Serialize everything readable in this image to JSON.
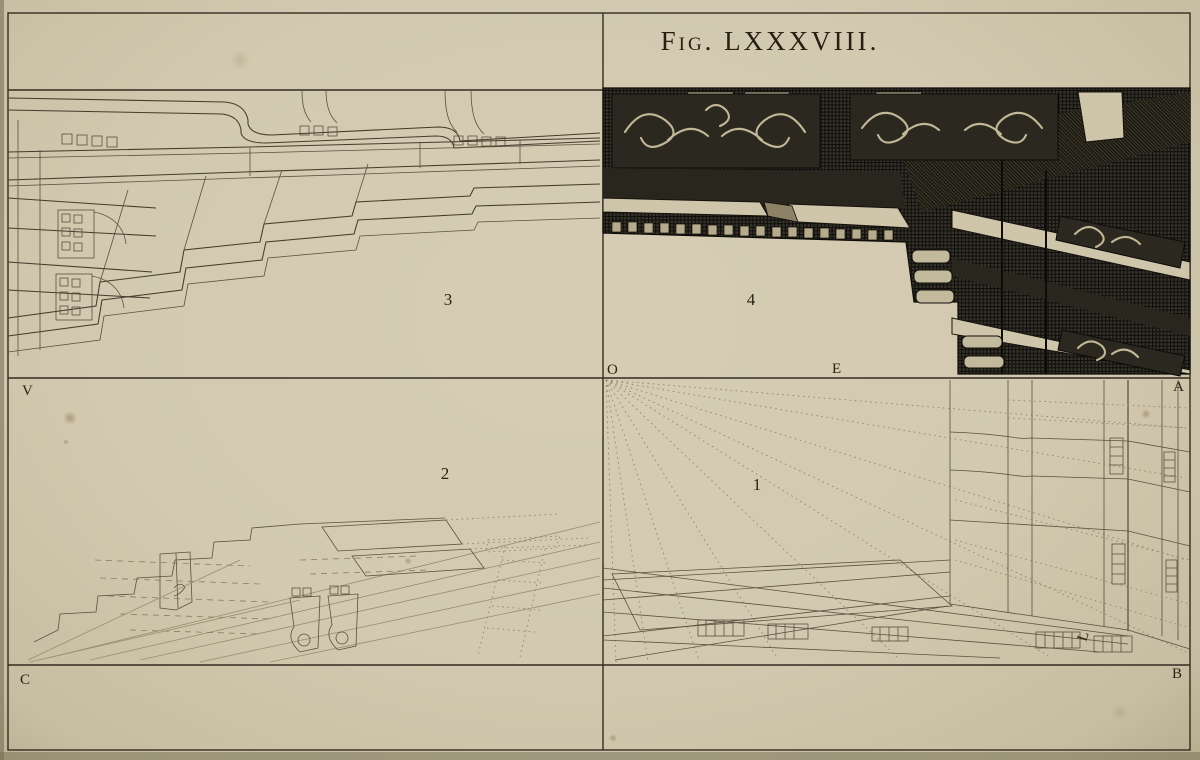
{
  "plate": {
    "title": "Fig. LXXXVIII."
  },
  "figure_labels": {
    "fig1": "1",
    "fig2": "2",
    "fig3": "3",
    "fig4": "4"
  },
  "point_labels": {
    "V": "V",
    "O": "O",
    "E": "E",
    "A": "A",
    "C": "C",
    "B": "B",
    "L": "L"
  },
  "colors": {
    "paper": "#d3cab1",
    "ink": "#3a3326",
    "engraving_dark": "#2a261d",
    "highlight": "#cfc5aa",
    "construction": "#9a8d70"
  }
}
